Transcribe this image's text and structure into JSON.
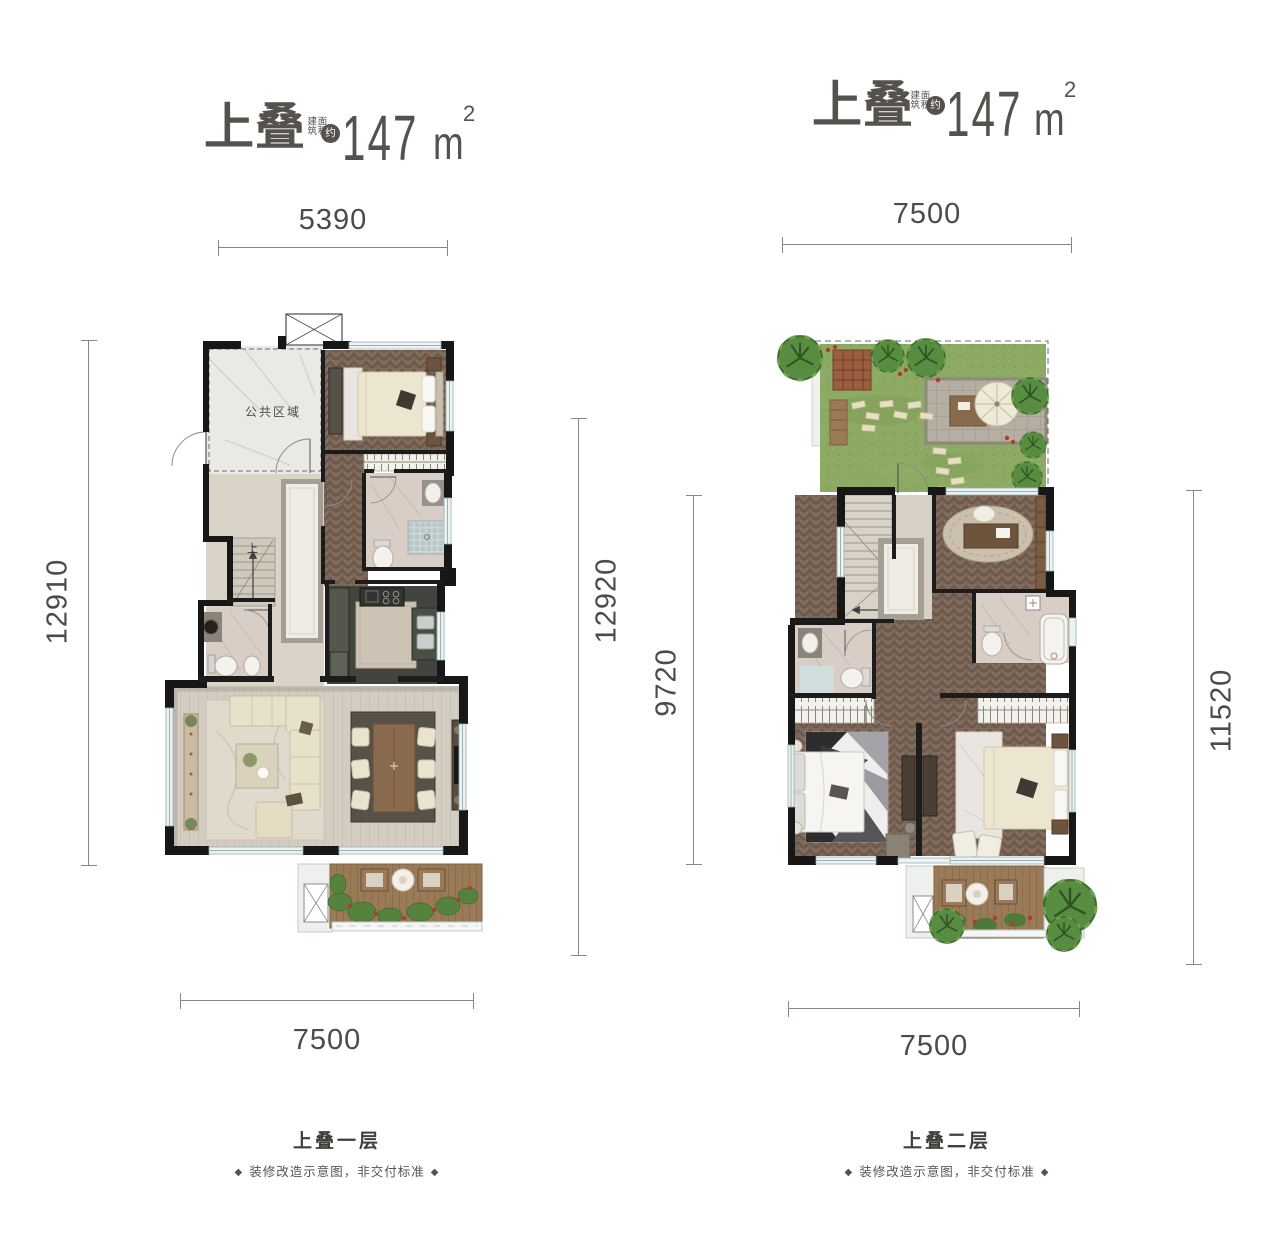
{
  "sheet": {
    "background": "#ffffff"
  },
  "palette": {
    "wall": "#171717",
    "dim_line": "#8b8681",
    "dim_text": "#4e4a46",
    "title_text": "#55514c",
    "caption_text": "#413e3b",
    "wood_dark": "#7b6656",
    "wood_light": "#d2ccc1",
    "deck": "#9a7a57",
    "lawn": "#8caa63",
    "tree": "#578c41",
    "marble": "#ebe9e5",
    "kitchen_floor": "#42453d",
    "sofa": "#e8e1ca",
    "window": "#eaf2f2"
  },
  "plans": [
    {
      "id": "upper-duplex-level-1",
      "title": {
        "name": "上叠",
        "area_prefix_vertical": "建筑面积",
        "approx_badge": "约",
        "area_value": "147",
        "area_unit": "m",
        "area_exponent": "2"
      },
      "dims": {
        "top": "5390",
        "left": "12910",
        "right": "12920",
        "bottom": "7500"
      },
      "labels": {
        "public_area": "公共区域",
        "stair": "上"
      },
      "caption": {
        "title": "上叠一层",
        "bullet_left": "◆",
        "note": "装修改造示意图，非交付标准",
        "bullet_right": "◆"
      }
    },
    {
      "id": "upper-duplex-level-2",
      "title": {
        "name": "上叠",
        "area_prefix_vertical": "建筑面积",
        "approx_badge": "约",
        "area_value": "147",
        "area_unit": "m",
        "area_exponent": "2"
      },
      "dims": {
        "top": "7500",
        "left": "9720",
        "right": "11520",
        "bottom": "7500"
      },
      "labels": {
        "stair": "下"
      },
      "caption": {
        "title": "上叠二层",
        "bullet_left": "◆",
        "note": "装修改造示意图，非交付标准",
        "bullet_right": "◆"
      }
    }
  ]
}
